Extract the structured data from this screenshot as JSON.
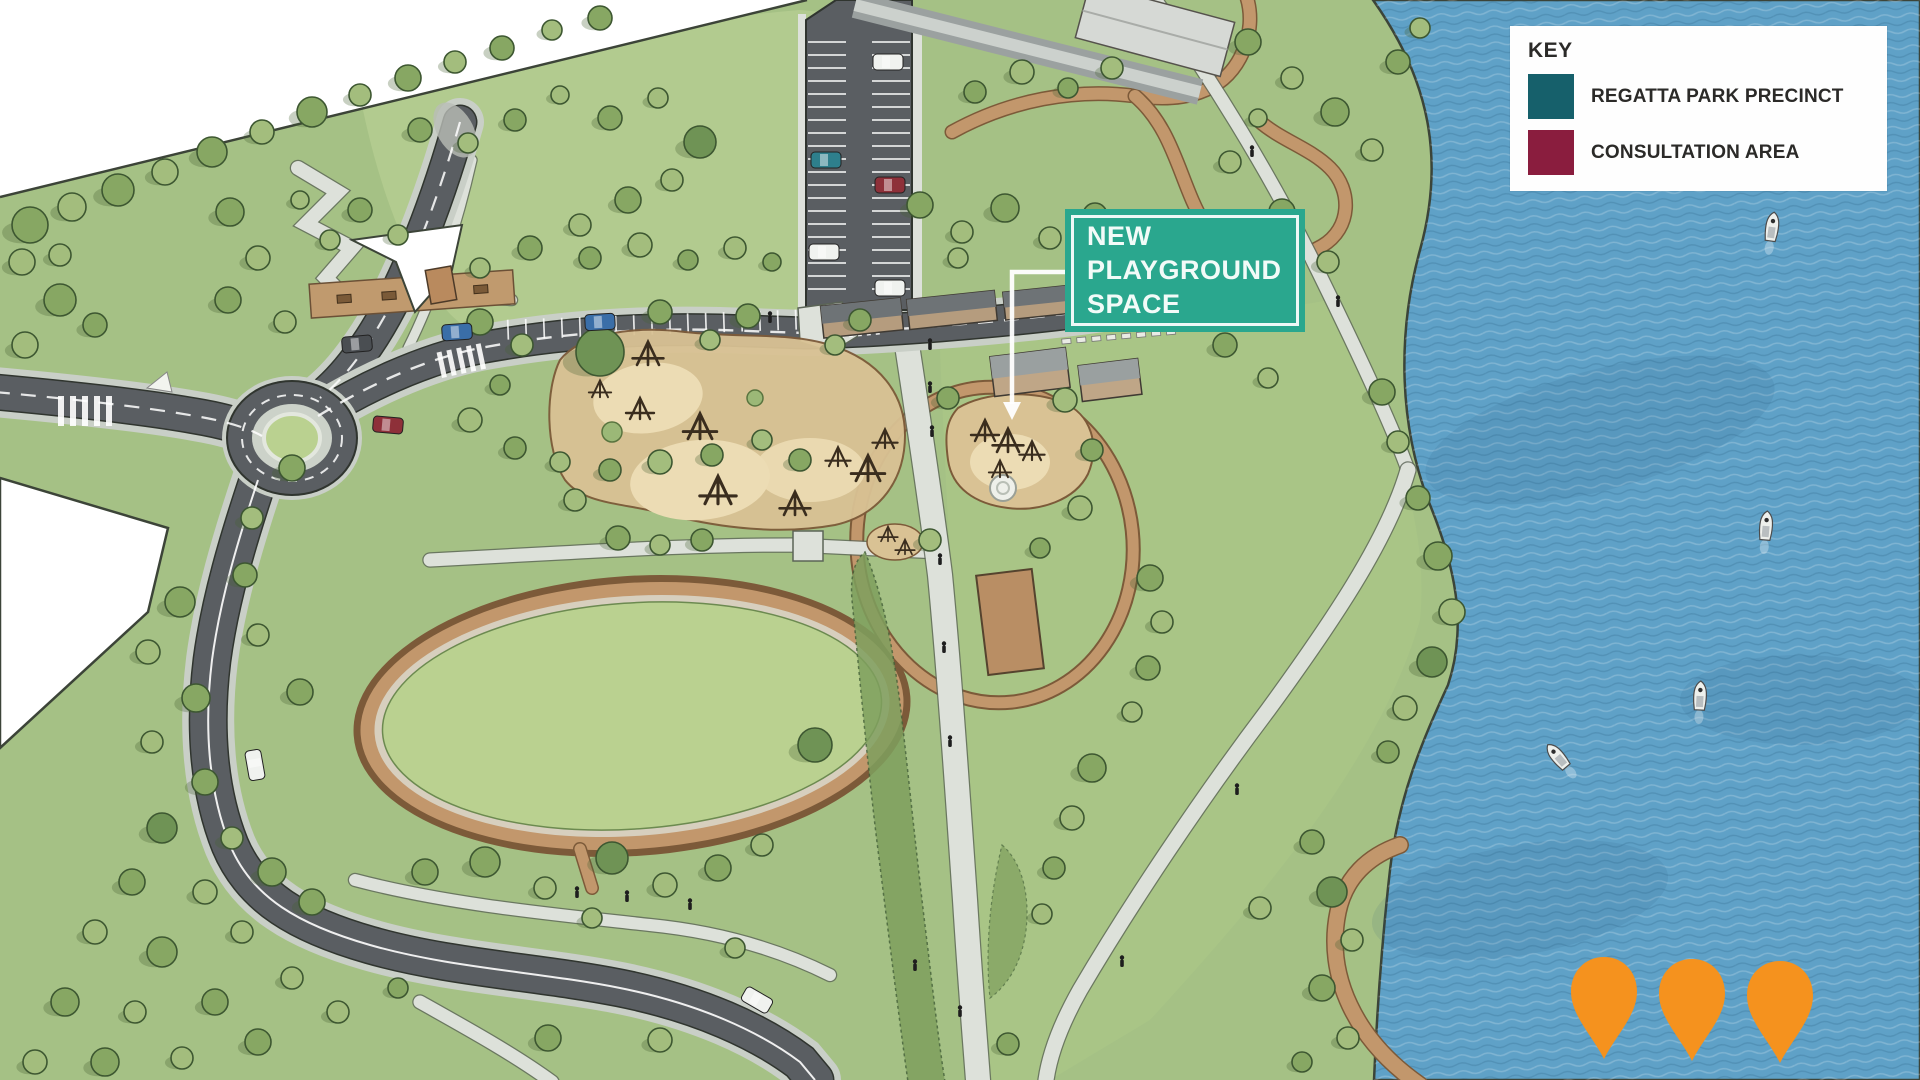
{
  "legend": {
    "title": "KEY",
    "items": [
      {
        "label": "REGATTA PARK PRECINCT",
        "color": "#16606b"
      },
      {
        "label": "CONSULTATION AREA",
        "color": "#8a1d3e"
      }
    ]
  },
  "callout": {
    "label": "NEW PLAYGROUND SPACE",
    "background": "#2aa78e",
    "text_color": "#f2fbf8"
  },
  "markers": {
    "count": 3,
    "color": "#f5921e"
  },
  "palette": {
    "water": "#5fa1c7",
    "wave_light": "rgba(255,255,255,0.20)",
    "wave_dark": "rgba(23,74,107,0.18)",
    "land": "#a5c185",
    "land_light": "#b8cf93",
    "land_mid": "#abc787",
    "field": "#bad190",
    "road": "#5a5e62",
    "road_edge": "#c9cfc7",
    "road_line": "#30352f",
    "path": "#dde1da",
    "path_edge": "#5b6456",
    "dirt": "#c2976c",
    "dirt_edge": "#7c5a39",
    "sand": "#d9c294",
    "sand_light": "#ecdcb4",
    "tree_tones": [
      "#a3bd7d",
      "#87a763",
      "#6f9355"
    ],
    "tree_stroke": "#3d5731",
    "shadow": "rgba(73,98,52,0.30)",
    "shrub": "#7fa05e",
    "shrub_edge": "#46633a",
    "building_wall": "#b59c7e",
    "building_roof": "#6e7376",
    "building_light": "#d6d9d5",
    "boundary": "#3c4438",
    "white": "#ffffff",
    "equip": "#3a2d1e"
  }
}
